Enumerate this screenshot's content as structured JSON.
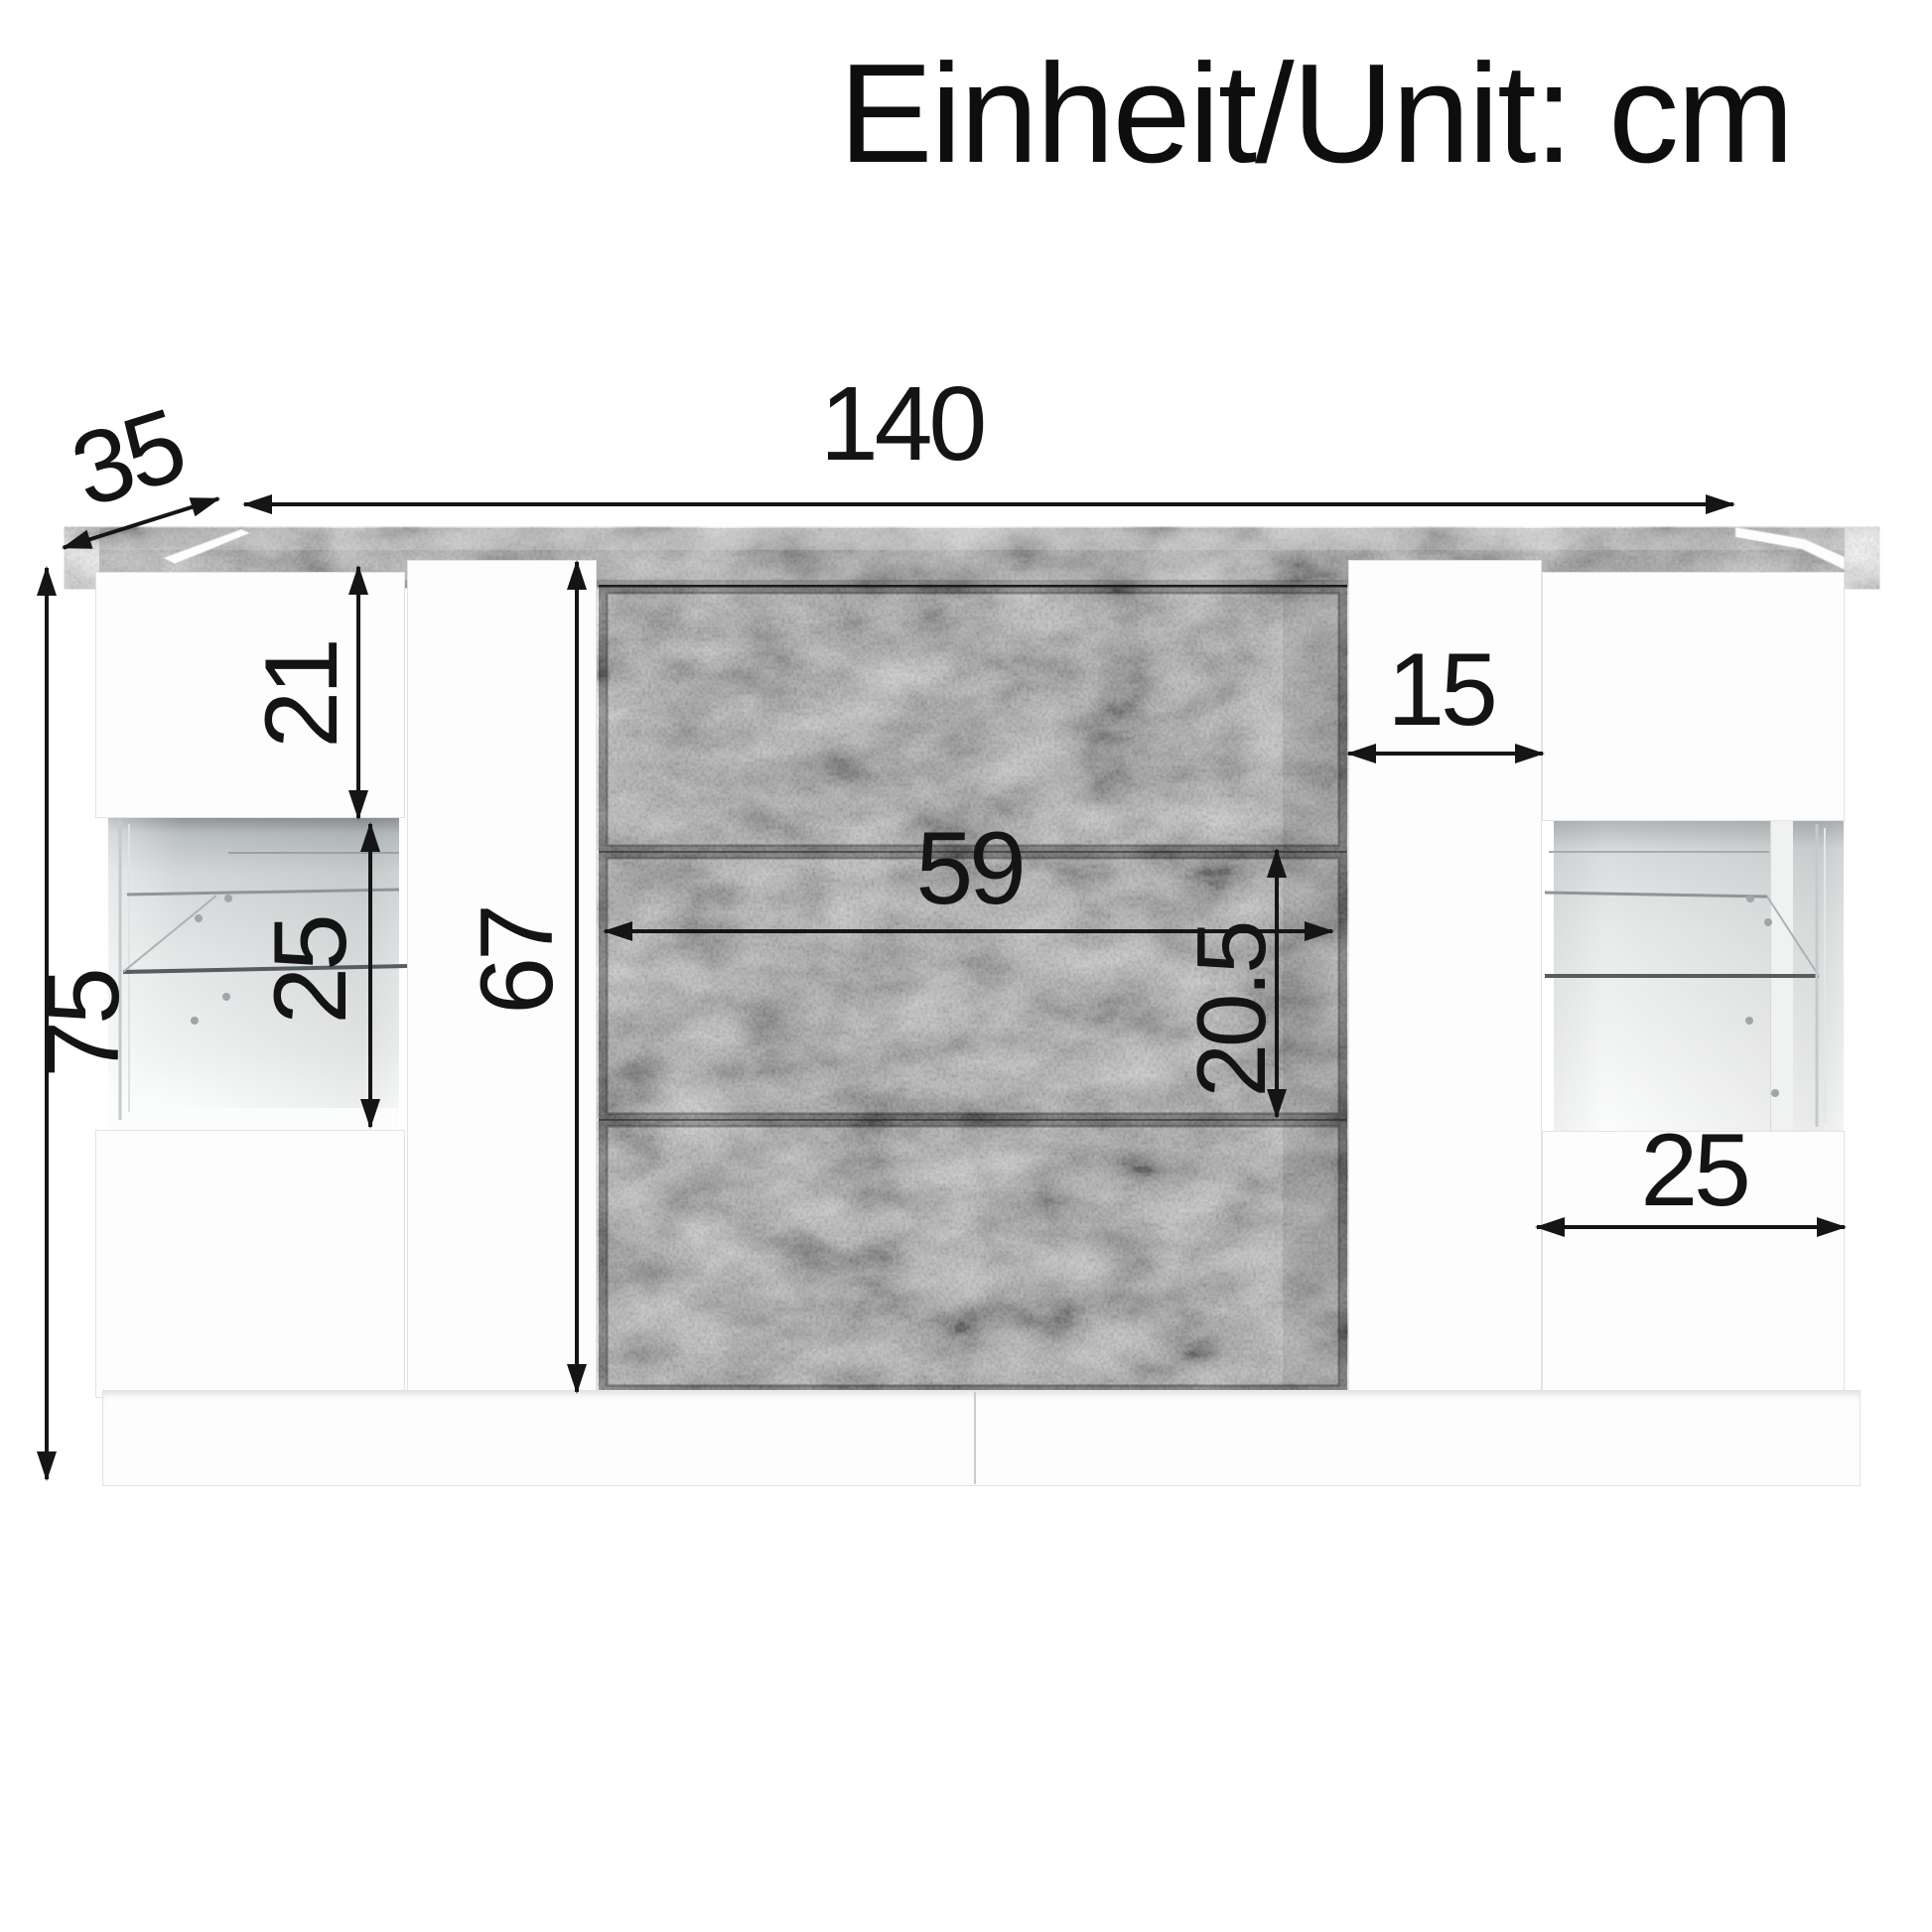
{
  "title": "Einheit/Unit: cm",
  "unit": "cm",
  "dimensions": {
    "total_width": "140",
    "depth": "35",
    "total_height": "75",
    "left_door_height": "21",
    "left_niche_height": "25",
    "body_height": "67",
    "drawer_width": "59",
    "drawer_height": "20.5",
    "side_door_width": "15",
    "right_niche_width": "25"
  }
}
